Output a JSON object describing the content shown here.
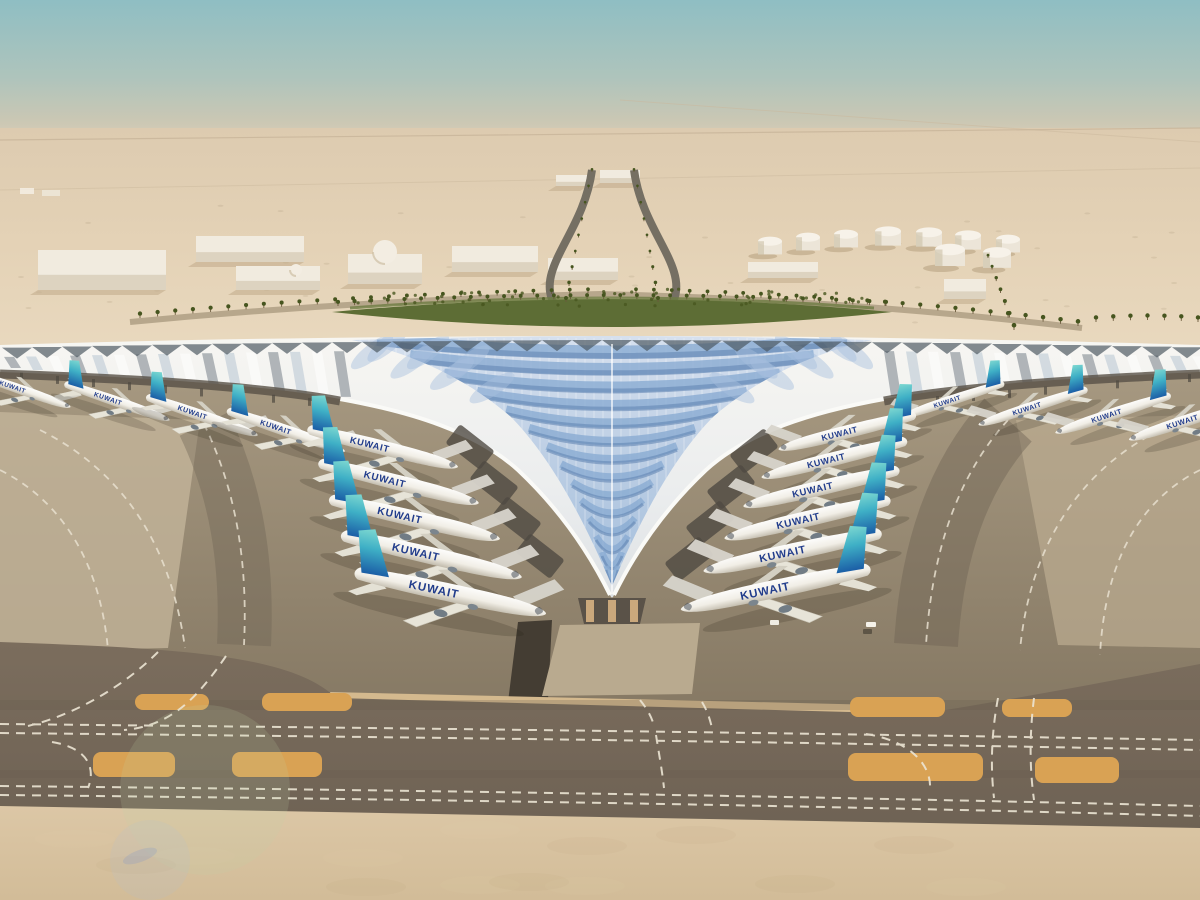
{
  "image": {
    "type": "aerial-architectural-rendering",
    "subject": "Desert airport terminal with white swooping trefoil roof, blue feather glazing, and aircraft parked at angled gates",
    "setting": "desert haze horizon"
  },
  "aircraft": {
    "label": "KUWAIT",
    "label_color": "#223d8c",
    "fin_gradient": [
      "#84dcd2",
      "#3fb0c6",
      "#1959a4"
    ],
    "left_wing_row": [
      {
        "x": 22,
        "y": 390,
        "a": 19,
        "s": 0.62
      },
      {
        "x": 118,
        "y": 402,
        "a": 19,
        "s": 0.66
      },
      {
        "x": 203,
        "y": 416,
        "a": 19,
        "s": 0.7
      },
      {
        "x": 287,
        "y": 431,
        "a": 19,
        "s": 0.74
      }
    ],
    "left_column": [
      {
        "x": 384,
        "y": 448,
        "a": 14,
        "s": 0.92
      },
      {
        "x": 400,
        "y": 483,
        "a": 14,
        "s": 0.98
      },
      {
        "x": 416,
        "y": 519,
        "a": 13,
        "s": 1.04
      },
      {
        "x": 433,
        "y": 556,
        "a": 13,
        "s": 1.1
      },
      {
        "x": 452,
        "y": 593,
        "a": 12,
        "s": 1.16
      }
    ],
    "right_column": [
      {
        "x": 846,
        "y": 432,
        "a": -14,
        "s": 0.84
      },
      {
        "x": 833,
        "y": 459,
        "a": -14,
        "s": 0.89
      },
      {
        "x": 820,
        "y": 488,
        "a": -13,
        "s": 0.95
      },
      {
        "x": 806,
        "y": 519,
        "a": -13,
        "s": 1.01
      },
      {
        "x": 791,
        "y": 552,
        "a": -12,
        "s": 1.08
      },
      {
        "x": 774,
        "y": 589,
        "a": -12,
        "s": 1.15
      }
    ],
    "right_wing_row": [
      {
        "x": 952,
        "y": 400,
        "a": -18,
        "s": 0.64
      },
      {
        "x": 1032,
        "y": 407,
        "a": -18,
        "s": 0.68
      },
      {
        "x": 1112,
        "y": 414,
        "a": -18,
        "s": 0.72
      },
      {
        "x": 1188,
        "y": 420,
        "a": -18,
        "s": 0.75
      }
    ]
  },
  "background": {
    "buildings": [
      {
        "x": 38,
        "y": 250,
        "w": 128,
        "h": 40
      },
      {
        "x": 196,
        "y": 236,
        "w": 108,
        "h": 26
      },
      {
        "x": 236,
        "y": 266,
        "w": 84,
        "h": 24
      },
      {
        "x": 348,
        "y": 254,
        "w": 74,
        "h": 30
      },
      {
        "x": 452,
        "y": 246,
        "w": 86,
        "h": 26
      },
      {
        "x": 548,
        "y": 258,
        "w": 70,
        "h": 22
      },
      {
        "x": 600,
        "y": 170,
        "w": 40,
        "h": 13
      },
      {
        "x": 556,
        "y": 175,
        "w": 32,
        "h": 11
      },
      {
        "x": 748,
        "y": 262,
        "w": 70,
        "h": 16
      },
      {
        "x": 944,
        "y": 279,
        "w": 42,
        "h": 20
      }
    ],
    "domes": [
      {
        "x": 385,
        "y": 252,
        "r": 12
      },
      {
        "x": 296,
        "y": 270,
        "r": 6
      }
    ],
    "fuel_tanks": [
      {
        "x": 770,
        "y": 252,
        "r": 12
      },
      {
        "x": 808,
        "y": 248,
        "r": 12
      },
      {
        "x": 846,
        "y": 245,
        "r": 12
      },
      {
        "x": 888,
        "y": 243,
        "r": 13
      },
      {
        "x": 929,
        "y": 244,
        "r": 13
      },
      {
        "x": 968,
        "y": 247,
        "r": 13
      },
      {
        "x": 1008,
        "y": 250,
        "r": 12
      },
      {
        "x": 950,
        "y": 263,
        "r": 15
      },
      {
        "x": 997,
        "y": 265,
        "r": 14
      }
    ],
    "palm_rows": [
      {
        "x1": 140,
        "y1": 318,
        "cx": 360,
        "cy": 298,
        "x2": 588,
        "y2": 293,
        "n": 26
      },
      {
        "x1": 636,
        "y1": 293,
        "cx": 860,
        "cy": 298,
        "x2": 1078,
        "y2": 326,
        "n": 26
      },
      {
        "x1": 338,
        "y1": 306,
        "cx": 612,
        "cy": 292,
        "x2": 886,
        "y2": 306,
        "n": 34
      },
      {
        "x1": 566,
        "y1": 302,
        "cx": 578,
        "cy": 238,
        "x2": 592,
        "y2": 172,
        "n": 9
      },
      {
        "x1": 658,
        "y1": 302,
        "cx": 648,
        "cy": 238,
        "x2": 634,
        "y2": 172,
        "n": 9
      },
      {
        "x1": 988,
        "y1": 258,
        "cx": 1000,
        "cy": 292,
        "x2": 1014,
        "y2": 330,
        "n": 7
      },
      {
        "x1": 1096,
        "y1": 322,
        "cx": 1148,
        "cy": 318,
        "x2": 1198,
        "y2": 322,
        "n": 7
      }
    ]
  },
  "airfield": {
    "sand_islands": [
      {
        "x": 135,
        "y": 694,
        "w": 74,
        "h": 16
      },
      {
        "x": 262,
        "y": 693,
        "w": 90,
        "h": 18
      },
      {
        "x": 850,
        "y": 697,
        "w": 95,
        "h": 20
      },
      {
        "x": 1002,
        "y": 699,
        "w": 70,
        "h": 18
      },
      {
        "x": 93,
        "y": 752,
        "w": 82,
        "h": 25
      },
      {
        "x": 232,
        "y": 752,
        "w": 90,
        "h": 25
      },
      {
        "x": 848,
        "y": 753,
        "w": 135,
        "h": 28
      },
      {
        "x": 1035,
        "y": 757,
        "w": 84,
        "h": 26
      }
    ]
  },
  "colors": {
    "sky_top": "#8fbec3",
    "sky_haze": "#d9cdb6",
    "desert": "#e4d2b6",
    "green_landscape": "#5d6d35",
    "roof_white": "#f2f1ec",
    "glazing_blue": "#8aabd2",
    "glazing_deep": "#6487b4",
    "pv_dark": "#4a555f",
    "apron": "#96886f",
    "taxiway": "#75675a",
    "sand_island": "#d9a254",
    "bottom_pavement": "#d8c2a1",
    "building_white": "#f1ebdf",
    "palm_green": "#46551f"
  },
  "counts": {
    "aircraft": 19,
    "fuel_tanks": 9,
    "palm_rows": 7,
    "sand_islands": 8
  }
}
